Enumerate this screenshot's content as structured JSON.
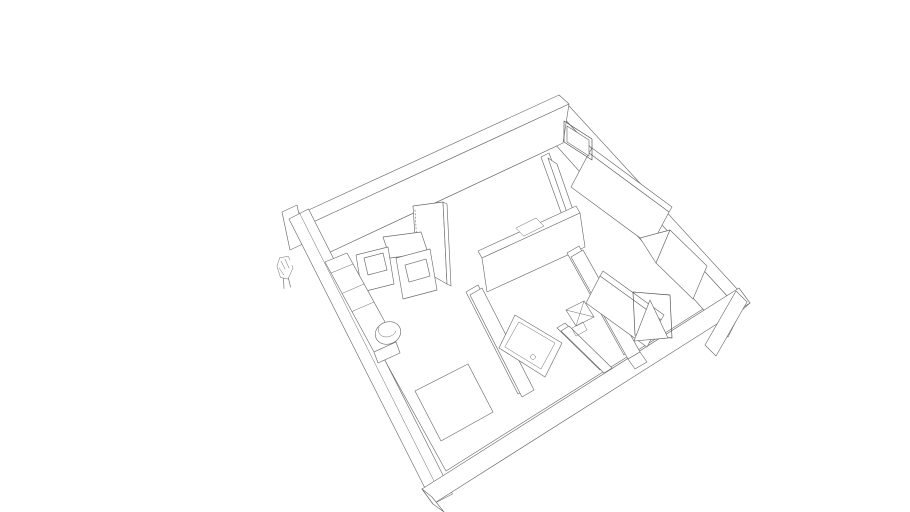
{
  "scene": {
    "description": "3D architectural model of a small apartment floor plan, viewed in axonometric perspective from above on a white background",
    "elements": [
      "exterior-walls",
      "interior-partitions",
      "entry-door",
      "open-interior-door",
      "glass-partition",
      "kitchen-counter",
      "kitchen-island-cabinets",
      "kitchen-wall-panel",
      "dining-table",
      "round-stool",
      "bed-platform",
      "bathtub",
      "shower-tray",
      "floor-mat",
      "scale-figure"
    ],
    "colors": {
      "background": "#ffffff",
      "floor": "#fdfdfd",
      "wall_top_white": "#fafbfc",
      "wall_cap_white": "#f7f8f9",
      "wall_face_light": "#d7d8da",
      "wall_face_gray": "#9a9b9d",
      "wall_face_mid": "#97989a",
      "wall_face_gray_dark": "#8c8d8f",
      "wall_end_light": "#c9cacb",
      "wall_edge_shade": "#b9babc",
      "band_bottom_top": "#dfe0e2",
      "band_end_cap": "#c7c8ca",
      "door_panel": "#939496",
      "door_wedge": "#88898b",
      "glass_panel": "#8d9dab",
      "counter_top": "#b9c8d4",
      "counter_front": "#a3b7c7",
      "box_inset": "#c3d1da",
      "white_fixture": "#fdfdfe",
      "figure_hair": "#2d2118",
      "figure_skin": "#c79b6e",
      "figure_dress": "#bf9a33",
      "figure_dress_dark": "#7d621c",
      "figure_shoes": "#1d1a16",
      "handle_dark": "#3a3b3c"
    }
  }
}
